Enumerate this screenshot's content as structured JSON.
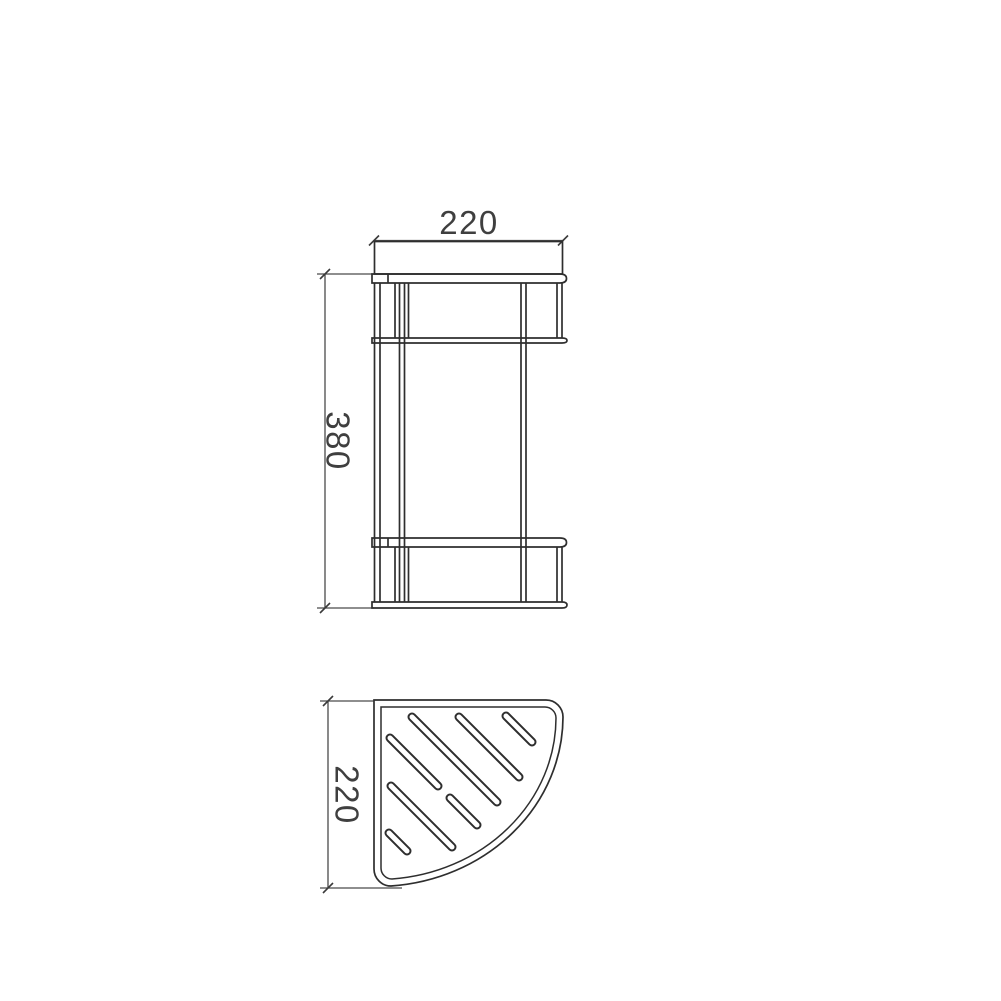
{
  "drawing": {
    "description": "Technical dimension drawing of a two-tier corner shower basket shelf",
    "background": "#ffffff",
    "line_color": "#2e2e2e",
    "dim_color": "#4a4a4a",
    "text_color": "#3f3f3f",
    "front_view": {
      "name": "front elevation with two baskets",
      "width_dim": "220",
      "height_dim": "380"
    },
    "plan_view": {
      "name": "quarter-circle shelf plan with drain slots",
      "depth_dim": "220",
      "slots": [
        [
          506,
          716,
          532,
          742
        ],
        [
          459,
          717,
          519,
          777
        ],
        [
          412,
          717,
          497,
          802
        ],
        [
          390,
          738,
          438,
          786
        ],
        [
          450,
          798,
          477,
          825
        ],
        [
          391,
          786,
          452,
          847
        ],
        [
          389,
          833,
          407,
          851
        ]
      ]
    }
  }
}
